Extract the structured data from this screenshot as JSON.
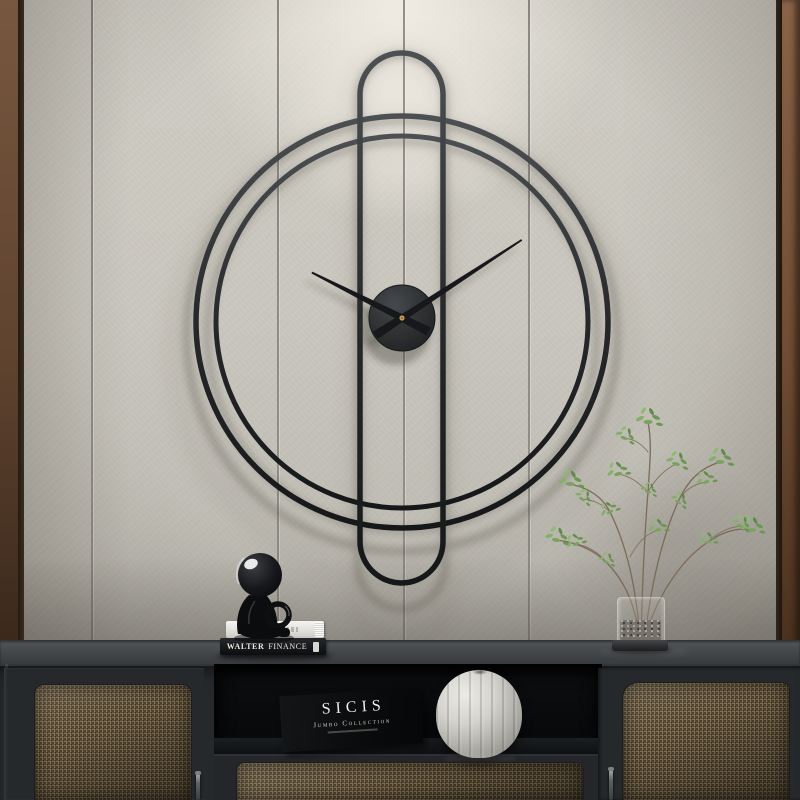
{
  "scene": {
    "type": "interior product photograph",
    "subject": "Minimalist black metal wall clock above a dark rattan sideboard",
    "wall": {
      "panel_color": "#c9c6be",
      "seam_positions_px": [
        91,
        277,
        403,
        528
      ],
      "accent_strip_left_color": "#6e4f38",
      "accent_strip_right_color": "#7c5639",
      "spotlight": "soft glow at top center"
    },
    "clock": {
      "style": "double ring with elongated pill frame",
      "frame_color": "#1d1f21",
      "outer_ring_radius_px": 206,
      "inner_ring_radius_px": 186,
      "center_disc_color": "#303335",
      "center_pin_color": "#c89a5a",
      "hour_hand_angle_deg_from_12": 297,
      "minute_hand_angle_deg_from_12": 57
    },
    "sideboard": {
      "body_color": "#26292c",
      "top_color": "#4a4d50",
      "rattan_color": "#8b795a",
      "sections": [
        "left rattan door",
        "open shelf",
        "rattan drawer",
        "right rattan door"
      ],
      "handle_color": "#8d9093"
    },
    "decor": {
      "figurine": "glossy black sitting figure on book stack",
      "book_stack_count": 2,
      "pumpkin_vase_color": "#d8d6d1",
      "plant": "delicate green-leaf branches in glass vase with gravel"
    }
  },
  "texts": {
    "book_spine": {
      "word1": "WALTER",
      "word2": "FINANCE"
    },
    "box": {
      "title": "SICIS",
      "subtitle": "Jumbo Collection"
    }
  }
}
